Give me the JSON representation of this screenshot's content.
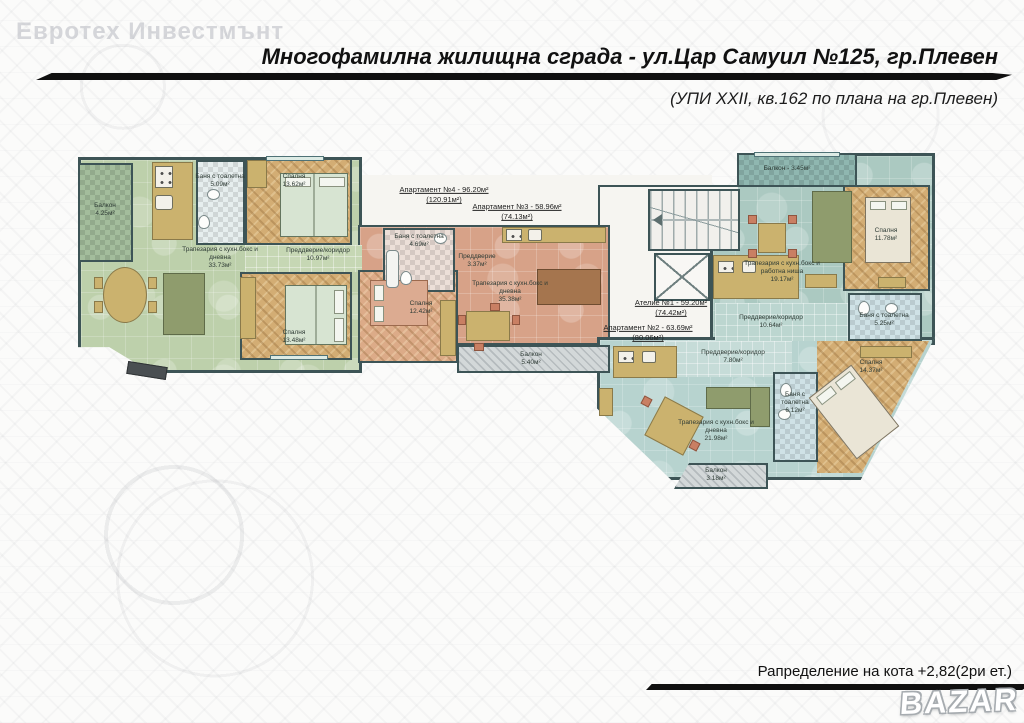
{
  "watermarks": {
    "top_left": "Евротех Инвестмънт",
    "bazar": "BAZAR"
  },
  "header": {
    "title": "Многофамилна жилищна сграда - ул.Цар Самуил №125, гр.Плевен",
    "subtitle": "(УПИ XXII, кв.162 по плана на гр.Плевен)"
  },
  "footer": {
    "caption": "Рапределение на кота +2,82(2ри ет.)"
  },
  "apartment_labels": {
    "apt4": {
      "line1": "Апартамент №4 - 96.20м²",
      "line2": "(120.91м²)"
    },
    "apt3": {
      "line1": "Апартамент №3 - 58.96м²",
      "line2": "(74.13м²)"
    },
    "atelier1": {
      "line1": "Ателие №1 - 59.20м²",
      "line2": "(74.42м²)"
    },
    "apt2": {
      "line1": "Апартамент №2 - 63.69м²",
      "line2": "(80.06м²)"
    }
  },
  "rooms": {
    "apt4": {
      "balcony": {
        "name": "Балкон",
        "area": "4.25м²"
      },
      "bath": {
        "name": "Баня с тоалетна",
        "area": "5.09м²"
      },
      "bedroom1": {
        "name": "Спалня",
        "area": "13.62м²"
      },
      "living": {
        "name": "Трапезария с кухн.бокс и дневна",
        "area": "33.73м²"
      },
      "hall": {
        "name": "Преддверие/коридор",
        "area": "10.97м²"
      },
      "bedroom2": {
        "name": "Спалня",
        "area": "13.48м²"
      }
    },
    "apt3": {
      "bath": {
        "name": "Баня с тоалетна",
        "area": "4.69м²"
      },
      "entry": {
        "name": "Преддверие",
        "area": "3.37м²"
      },
      "bedroom": {
        "name": "Спалня",
        "area": "12.42м²"
      },
      "living": {
        "name": "Трапезария с кухн.бокс и дневна",
        "area": "35.38м²"
      },
      "balcony": {
        "name": "Балкон",
        "area": "5.40м²"
      }
    },
    "atelier1": {
      "balcony": {
        "name": "Балкон - 3.45м²",
        "area": ""
      },
      "living": {
        "name": "Трапезария с кухн.бокс и работна ниша",
        "area": "19.17м²"
      },
      "bedroom": {
        "name": "Спалня",
        "area": "11.78м²"
      },
      "hall": {
        "name": "Преддверие/коридор",
        "area": "10.64м²"
      },
      "bath": {
        "name": "Баня с тоалетна",
        "area": "5.25м²"
      }
    },
    "apt2": {
      "hall": {
        "name": "Преддверие/коридор",
        "area": "7.80м²"
      },
      "living": {
        "name": "Трапезария с кухн.бокс и дневна",
        "area": "21.98м²"
      },
      "bath": {
        "name": "Баня с тоалетна",
        "area": "6.12м²"
      },
      "bedroom": {
        "name": "Спалня",
        "area": "14.37м²"
      },
      "balcony": {
        "name": "Балкон",
        "area": "3.18м²"
      }
    }
  },
  "colors": {
    "wall": "#3d5456",
    "apt4_green": "#bdd0ab",
    "apt3_salmon": "#d7a288",
    "atelier1_teal": "#abc9c1",
    "apt2_blue": "#b7d3cf",
    "parquet": "#d3ad74",
    "balcony_hatch": "#d3d8d9"
  }
}
